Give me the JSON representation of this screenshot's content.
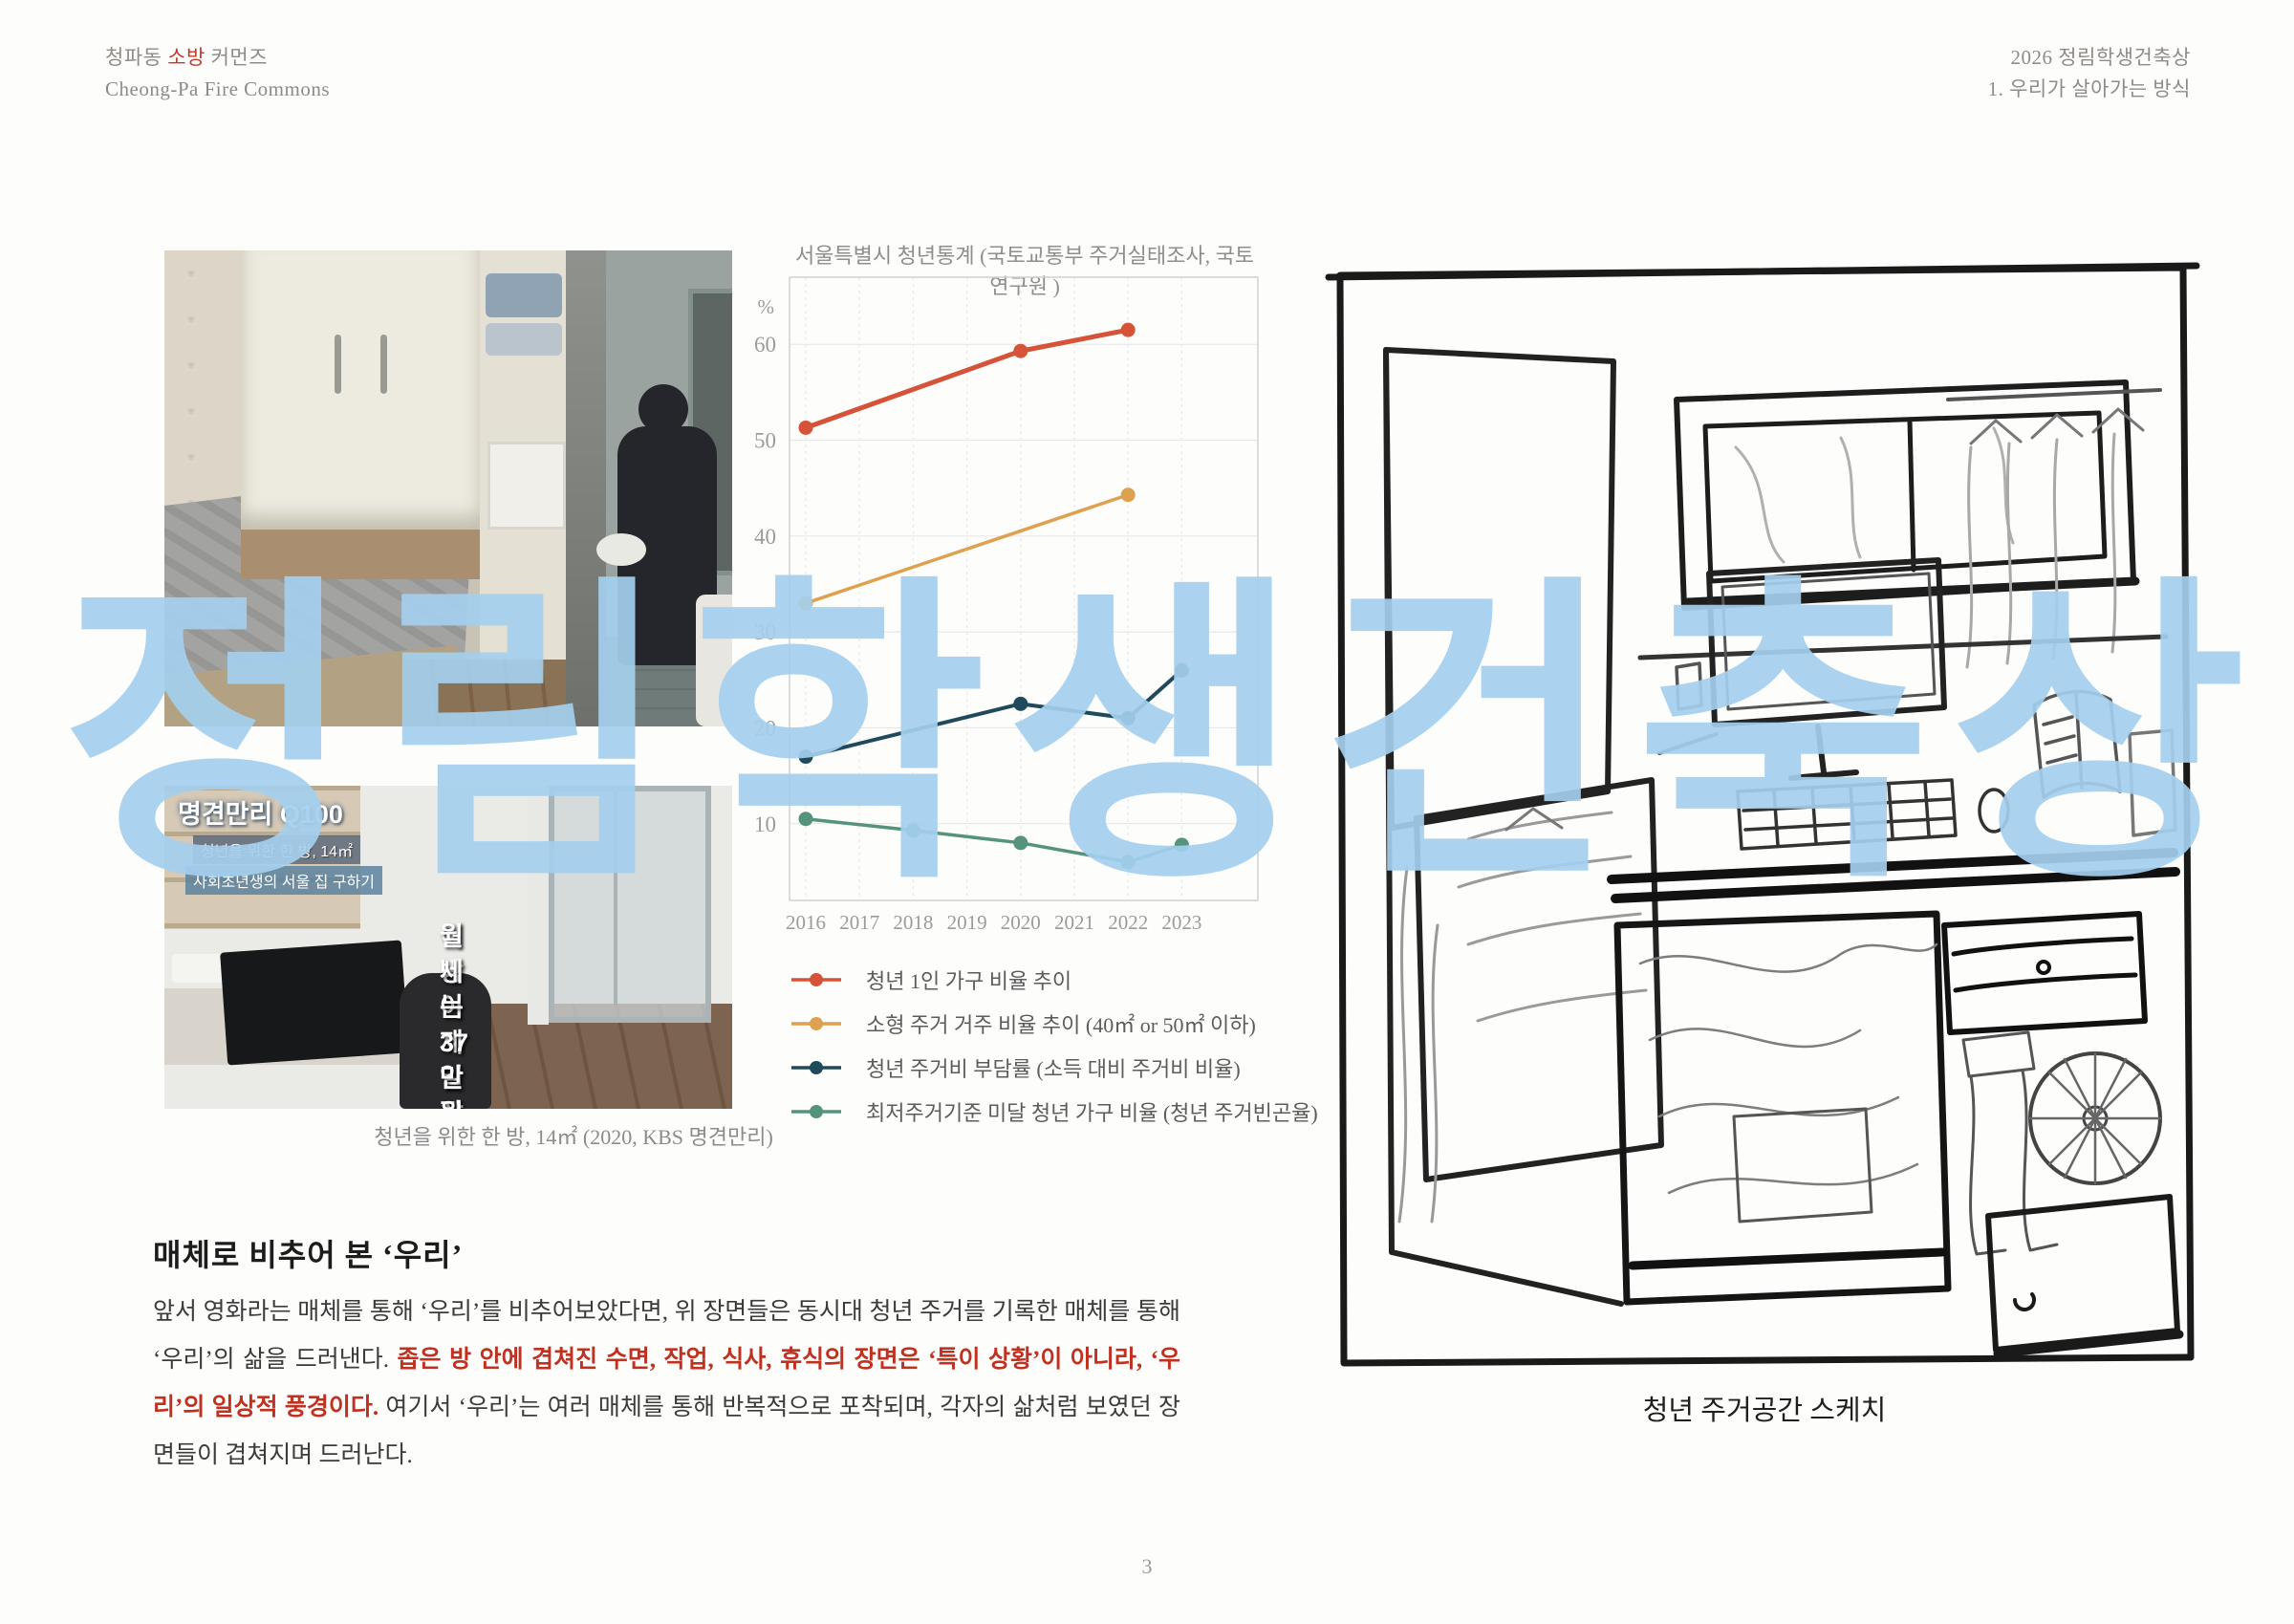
{
  "header": {
    "left_ko_prefix": "청파동 ",
    "left_ko_accent": "소방",
    "left_ko_suffix": " 커먼즈",
    "left_en": "Cheong-Pa Fire Commons",
    "right_line1": "2026 정림학생건축상",
    "right_line2": "1. 우리가 살아가는 방식"
  },
  "watermark_text": "정림학생건축상",
  "photos": {
    "overlay": {
      "logo": "명견만리 Q100",
      "chip1": "청년을 위한 한 방, 14㎡",
      "chip2": "사회초년생의 서울 집 구하기",
      "subtitle_line1": "이 방이 제일 잘 나가요",
      "subtitle_line2": "월세는 37만 원"
    },
    "caption": "청년을 위한 한 방, 14㎡ (2020, KBS 명견만리)"
  },
  "chart_data": {
    "type": "line",
    "title": "서울특별시 청년통계 (국토교통부 주거실태조사, 국토연구원 )",
    "x": [
      2016,
      2017,
      2018,
      2019,
      2020,
      2021,
      2022,
      2023
    ],
    "ylabel": "%",
    "y_ticks": [
      60,
      50,
      40,
      30,
      20,
      10
    ],
    "ylim": [
      2,
      67
    ],
    "grid": true,
    "legend_position": "below-left",
    "series": [
      {
        "name": "청년 1인 가구 비율 추이",
        "color": "#d45339",
        "line_width": 5,
        "points": [
          {
            "x": 2016,
            "y": 51.3
          },
          {
            "x": 2020,
            "y": 59.3
          },
          {
            "x": 2022,
            "y": 61.5
          }
        ]
      },
      {
        "name": "소형 주거 거주 비율 추이 (40㎡ or 50㎡ 이하)",
        "color": "#dda14f",
        "line_width": 3.5,
        "points": [
          {
            "x": 2016,
            "y": 33
          },
          {
            "x": 2022,
            "y": 44.3
          }
        ]
      },
      {
        "name": "청년 주거비 부담률 (소득 대비 주거비 비율)",
        "color": "#1f4a5c",
        "line_width": 4,
        "points": [
          {
            "x": 2016,
            "y": 17
          },
          {
            "x": 2020,
            "y": 22.5
          },
          {
            "x": 2022,
            "y": 21
          },
          {
            "x": 2023,
            "y": 26
          }
        ]
      },
      {
        "name": "최저주거기준 미달 청년 가구 비율 (청년 주거빈곤율)",
        "color": "#55937d",
        "line_width": 3.5,
        "points": [
          {
            "x": 2016,
            "y": 10.5
          },
          {
            "x": 2018,
            "y": 9.3
          },
          {
            "x": 2020,
            "y": 8
          },
          {
            "x": 2022,
            "y": 6
          },
          {
            "x": 2023,
            "y": 7.8
          }
        ]
      }
    ]
  },
  "section": {
    "heading": "매체로 비추어 본 ‘우리’",
    "para_part1": "앞서 영화라는 매체를 통해 ‘우리’를 비추어보았다면,  위 장면들은 동시대 청년 주거를 기록한 매체를 통해 ‘우리’의 삶을 드러낸다. ",
    "para_red": "좁은 방 안에 겹쳐진 수면, 작업, 식사, 휴식의 장면은 ‘특이 상황’이 아니라, ‘우리’의 일상적 풍경이다.",
    "para_part3": " 여기서 ‘우리’는 여러 매체를 통해 반복적으로 포착되며, 각자의 삶처럼 보였던 장면들이 겹쳐지며 드러난다."
  },
  "sketch": {
    "caption": "청년 주거공간 스케치"
  },
  "footer": {
    "page_number": "3"
  }
}
